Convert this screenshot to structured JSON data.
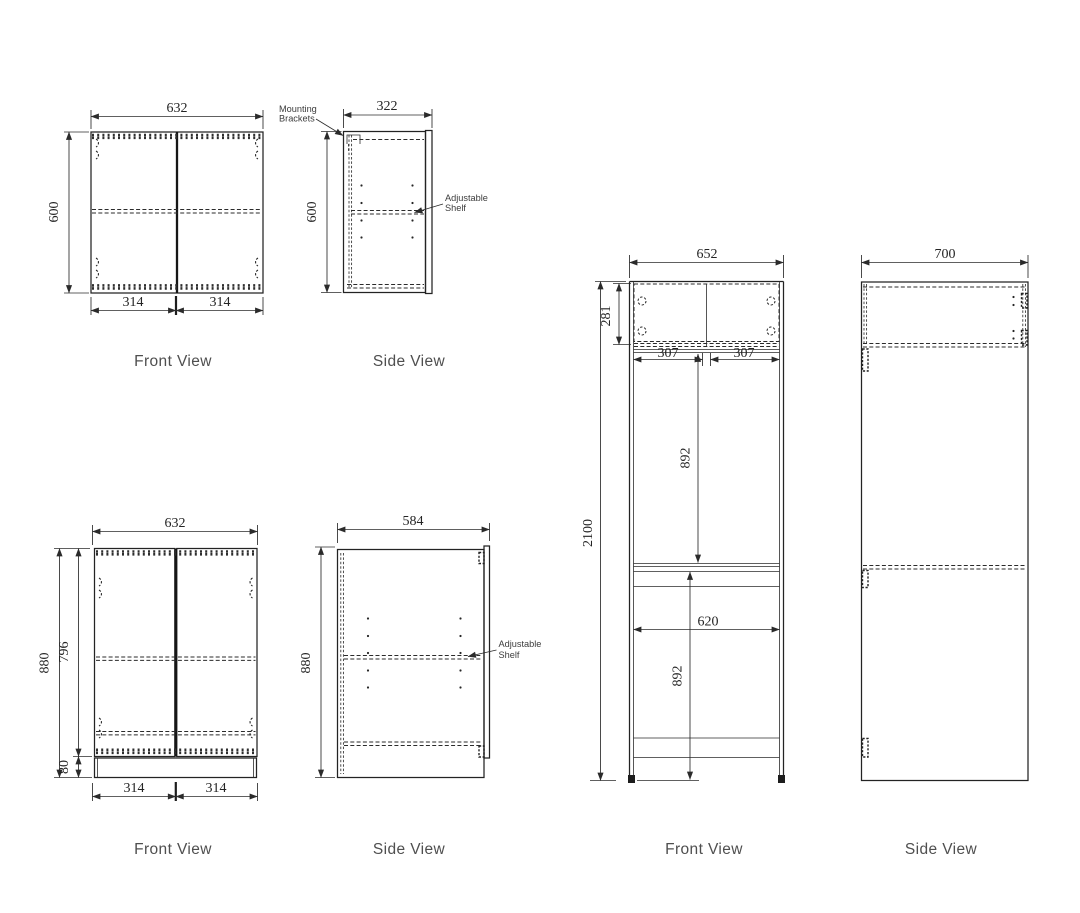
{
  "page": {
    "background": "#ffffff",
    "line_color": "#262626",
    "label_color": "#4f4f4f"
  },
  "views": {
    "wall_front": {
      "label": "Front View",
      "width": "632",
      "height": "600",
      "door_left": "314",
      "door_right": "314"
    },
    "wall_side": {
      "label": "Side View",
      "depth": "322",
      "height": "600",
      "note_mounting_l1": "Mounting",
      "note_mounting_l2": "Brackets",
      "note_shelf_l1": "Adjustable",
      "note_shelf_l2": "Shelf"
    },
    "base_front": {
      "label": "Front View",
      "width": "632",
      "height": "880",
      "door_height": "796",
      "plinth_height": "80",
      "door_left": "314",
      "door_right": "314"
    },
    "base_side": {
      "label": "Side View",
      "depth": "584",
      "height": "880",
      "note_shelf_l1": "Adjustable",
      "note_shelf_l2": "Shelf"
    },
    "tall_front": {
      "label": "Front View",
      "width": "652",
      "height": "2100",
      "top_section_height": "281",
      "top_door_left": "307",
      "top_door_right": "307",
      "upper_opening_height": "892",
      "lower_opening_width": "620",
      "lower_opening_height": "892"
    },
    "tall_side": {
      "label": "Side View",
      "depth": "700"
    }
  }
}
